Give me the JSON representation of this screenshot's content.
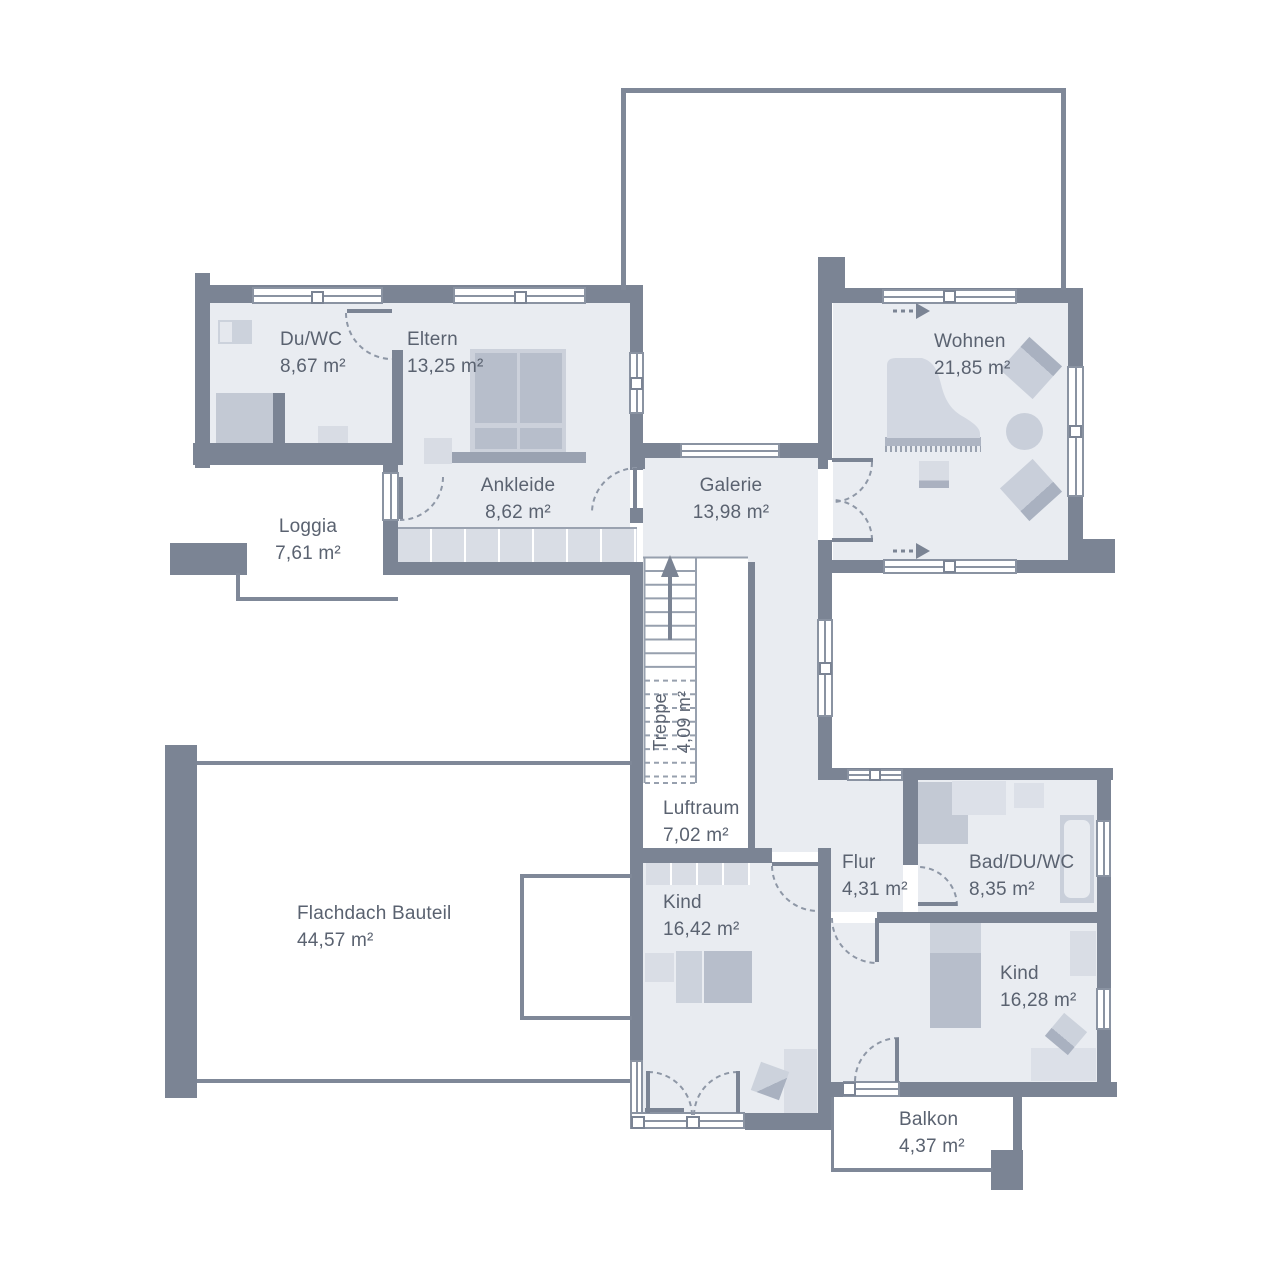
{
  "plan": {
    "type": "floor-plan",
    "language": "de",
    "rooms": {
      "du_wc": {
        "name": "Du/WC",
        "area": "8,67 m²"
      },
      "eltern": {
        "name": "Eltern",
        "area": "13,25 m²"
      },
      "ankleide": {
        "name": "Ankleide",
        "area": "8,62 m²"
      },
      "loggia": {
        "name": "Loggia",
        "area": "7,61 m²"
      },
      "galerie": {
        "name": "Galerie",
        "area": "13,98 m²"
      },
      "wohnen": {
        "name": "Wohnen",
        "area": "21,85 m²"
      },
      "treppe": {
        "name": "Treppe",
        "area": "4,09 m²"
      },
      "luftraum": {
        "name": "Luftraum",
        "area": "7,02 m²"
      },
      "flachdach": {
        "name": "Flachdach Bauteil",
        "area": "44,57 m²"
      },
      "kind_links": {
        "name": "Kind",
        "area": "16,42 m²"
      },
      "flur": {
        "name": "Flur",
        "area": "4,31 m²"
      },
      "bad": {
        "name": "Bad/DU/WC",
        "area": "8,35 m²"
      },
      "kind_rechts": {
        "name": "Kind",
        "area": "16,28 m²"
      },
      "balkon": {
        "name": "Balkon",
        "area": "4,37 m²"
      }
    },
    "colors": {
      "wall": "#7b8494",
      "room_fill": "#e9ecf1",
      "furniture_light": "#d9dde5",
      "furniture_mid": "#c9cfda",
      "furniture_dark": "#aab1c0",
      "label_text": "#5a6270",
      "outline": "#8a93a2"
    }
  }
}
